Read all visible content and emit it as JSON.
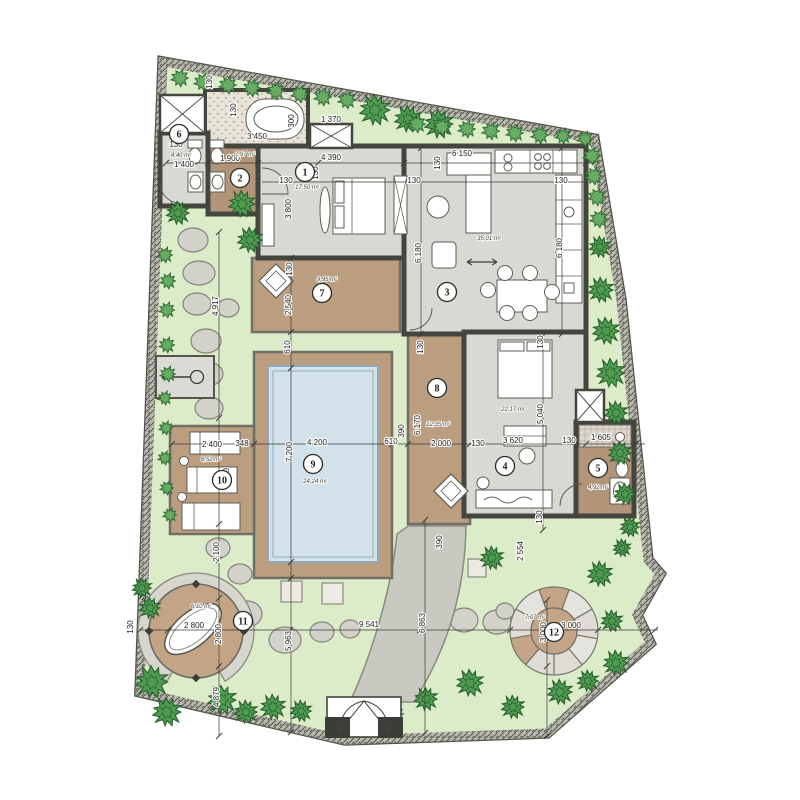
{
  "title": "villa-site-plan",
  "colors": {
    "paper": "#ffffff",
    "garden": "#dcebc8",
    "boundary_band": "#b9b9b0",
    "boundary_line": "#54544c",
    "wall": "#45453f",
    "room_gray": "#d9d9d4",
    "bath_brown": "#b29478",
    "deck_brown": "#bb9d7f",
    "gravel": "#e8e3d9",
    "pool_water": "#d3e2ea",
    "pool_line": "#8fa9b8",
    "stone": "#d2d1ca",
    "stone_line": "#83837b",
    "path": "#c9c9c2",
    "tree_big": "#4f9b51",
    "tree_big_line": "#27602c",
    "bush": "#68ab62",
    "bush_line": "#2f6b35",
    "dim_line": "#3c3c38",
    "round_deck": "#c3a486",
    "ring_gray": "#d6d6cf"
  },
  "boundary": [
    [
      163,
      62
    ],
    [
      594,
      139
    ],
    [
      621,
      300
    ],
    [
      648,
      560
    ],
    [
      660,
      574
    ],
    [
      637,
      615
    ],
    [
      650,
      643
    ],
    [
      547,
      733
    ],
    [
      345,
      740
    ],
    [
      140,
      692
    ]
  ],
  "rooms": [
    {
      "num": "1",
      "cx": 305,
      "cy": 172,
      "area": "17,50 m²",
      "ax": 307,
      "ay": 189
    },
    {
      "num": "2",
      "cx": 240,
      "cy": 178,
      "area": "7,97 m²",
      "ax": 245,
      "ay": 156
    },
    {
      "num": "3",
      "cx": 447,
      "cy": 292,
      "area": "35,01 m²",
      "ax": 489,
      "ay": 240
    },
    {
      "num": "4",
      "cx": 505,
      "cy": 466,
      "area": "22,17 m²",
      "ax": 513,
      "ay": 411
    },
    {
      "num": "5",
      "cx": 598,
      "cy": 468,
      "area": "4,92 m²",
      "ax": 598,
      "ay": 489
    },
    {
      "num": "6",
      "cx": 179,
      "cy": 134,
      "area": "4,40 m²",
      "ax": 181,
      "ay": 157
    },
    {
      "num": "7",
      "cx": 322,
      "cy": 293,
      "area": "9,95 m²",
      "ax": 327,
      "ay": 281
    },
    {
      "num": "8",
      "cx": 437,
      "cy": 388,
      "area": "12,35 m²",
      "ax": 438,
      "ay": 426
    },
    {
      "num": "9",
      "cx": 313,
      "cy": 464,
      "area": "24,24 m²",
      "ax": 315,
      "ay": 483
    },
    {
      "num": "10",
      "cx": 222,
      "cy": 480,
      "area": "8,52 m²",
      "ax": 211,
      "ay": 461
    },
    {
      "num": "11",
      "cx": 243,
      "cy": 621,
      "area": "6,10 m²",
      "ax": 201,
      "ay": 608
    },
    {
      "num": "12",
      "cx": 554,
      "cy": 632,
      "area": "7,07 m²",
      "ax": 535,
      "ay": 619
    }
  ],
  "dims": [
    {
      "t": "130",
      "x": 176,
      "y": 147,
      "r": 0
    },
    {
      "t": "1 400",
      "x": 184,
      "y": 167,
      "r": 0
    },
    {
      "t": "1 900",
      "x": 230,
      "y": 161,
      "r": 0
    },
    {
      "t": "130",
      "x": 212,
      "y": 82,
      "r": 90
    },
    {
      "t": "130",
      "x": 236,
      "y": 110,
      "r": 90
    },
    {
      "t": "3 450",
      "x": 257,
      "y": 139,
      "r": 0
    },
    {
      "t": "300",
      "x": 294,
      "y": 121,
      "r": 90
    },
    {
      "t": "1 370",
      "x": 331,
      "y": 122,
      "r": 0
    },
    {
      "t": "4 390",
      "x": 331,
      "y": 160,
      "r": 0
    },
    {
      "t": "130",
      "x": 318,
      "y": 173,
      "r": 90
    },
    {
      "t": "130",
      "x": 286,
      "y": 183,
      "r": 0
    },
    {
      "t": "3 800",
      "x": 291,
      "y": 209,
      "r": 90
    },
    {
      "t": "6 150",
      "x": 462,
      "y": 156,
      "r": 0
    },
    {
      "t": "130",
      "x": 414,
      "y": 183,
      "r": 0
    },
    {
      "t": "130",
      "x": 561,
      "y": 183,
      "r": 0
    },
    {
      "t": "130",
      "x": 440,
      "y": 163,
      "r": 90
    },
    {
      "t": "6 180",
      "x": 421,
      "y": 253,
      "r": 90
    },
    {
      "t": "6 180",
      "x": 562,
      "y": 248,
      "r": 90
    },
    {
      "t": "130",
      "x": 292,
      "y": 269,
      "r": 90
    },
    {
      "t": "2 540",
      "x": 291,
      "y": 305,
      "r": 90
    },
    {
      "t": "610",
      "x": 290,
      "y": 347,
      "r": 90
    },
    {
      "t": "130",
      "x": 423,
      "y": 347,
      "r": 90
    },
    {
      "t": "130",
      "x": 543,
      "y": 342,
      "r": 90
    },
    {
      "t": "5 040",
      "x": 543,
      "y": 414,
      "r": 90
    },
    {
      "t": "6 170",
      "x": 420,
      "y": 425,
      "r": 90
    },
    {
      "t": "390",
      "x": 404,
      "y": 431,
      "r": 90
    },
    {
      "t": "2 400",
      "x": 212,
      "y": 447,
      "r": 0
    },
    {
      "t": "348",
      "x": 242,
      "y": 446,
      "r": 0
    },
    {
      "t": "4 200",
      "x": 317,
      "y": 445,
      "r": 0
    },
    {
      "t": "610",
      "x": 391,
      "y": 444,
      "r": 0
    },
    {
      "t": "2 000",
      "x": 441,
      "y": 446,
      "r": 0
    },
    {
      "t": "130",
      "x": 478,
      "y": 446,
      "r": 0
    },
    {
      "t": "3 620",
      "x": 513,
      "y": 443,
      "r": 0
    },
    {
      "t": "130",
      "x": 569,
      "y": 443,
      "r": 0
    },
    {
      "t": "1 605",
      "x": 601,
      "y": 440,
      "r": 0
    },
    {
      "t": "7 200",
      "x": 292,
      "y": 452,
      "r": 90
    },
    {
      "t": "3 550",
      "x": 229,
      "y": 478,
      "r": 90
    },
    {
      "t": "2 100",
      "x": 219,
      "y": 552,
      "r": 90
    },
    {
      "t": "4 917",
      "x": 218,
      "y": 306,
      "r": 90
    },
    {
      "t": "130",
      "x": 542,
      "y": 517,
      "r": 90
    },
    {
      "t": "2 554",
      "x": 523,
      "y": 551,
      "r": 90
    },
    {
      "t": "390",
      "x": 442,
      "y": 542,
      "r": 90
    },
    {
      "t": "2 800",
      "x": 194,
      "y": 628,
      "r": 0
    },
    {
      "t": "2 800",
      "x": 221,
      "y": 634,
      "r": 90
    },
    {
      "t": "4 879",
      "x": 219,
      "y": 697,
      "r": 90
    },
    {
      "t": "5 963",
      "x": 291,
      "y": 641,
      "r": 90
    },
    {
      "t": "9 541",
      "x": 369,
      "y": 627,
      "r": 0
    },
    {
      "t": "6 863",
      "x": 425,
      "y": 623,
      "r": 90
    },
    {
      "t": "3 000",
      "x": 571,
      "y": 628,
      "r": 0
    },
    {
      "t": "3 000",
      "x": 546,
      "y": 632,
      "r": 90
    },
    {
      "t": "130",
      "x": 133,
      "y": 627,
      "r": 90
    }
  ],
  "dim_lines": [
    [
      166,
      163,
      596,
      163
    ],
    [
      262,
      182,
      586,
      182
    ],
    [
      172,
      444,
      645,
      444
    ],
    [
      140,
      630,
      658,
      630
    ],
    [
      219,
      232,
      219,
      736
    ],
    [
      291,
      258,
      291,
      732
    ],
    [
      425,
      520,
      425,
      733
    ],
    [
      547,
      600,
      547,
      736
    ],
    [
      543,
      336,
      543,
      530
    ],
    [
      421,
      148,
      421,
      334
    ],
    [
      562,
      148,
      562,
      334
    ]
  ],
  "trees_big": [
    [
      375,
      110,
      16
    ],
    [
      408,
      119,
      14
    ],
    [
      439,
      124,
      15
    ],
    [
      178,
      213,
      12
    ],
    [
      242,
      204,
      14
    ],
    [
      250,
      240,
      13
    ],
    [
      600,
      247,
      11
    ],
    [
      601,
      290,
      13
    ],
    [
      606,
      331,
      14
    ],
    [
      611,
      373,
      15
    ],
    [
      616,
      413,
      12
    ],
    [
      620,
      453,
      12
    ],
    [
      625,
      494,
      11
    ],
    [
      630,
      527,
      10
    ],
    [
      622,
      548,
      9
    ],
    [
      600,
      574,
      13
    ],
    [
      492,
      558,
      12
    ],
    [
      152,
      682,
      17
    ],
    [
      167,
      712,
      15
    ],
    [
      222,
      700,
      15
    ],
    [
      246,
      712,
      12
    ],
    [
      273,
      707,
      13
    ],
    [
      301,
      711,
      11
    ],
    [
      426,
      699,
      12
    ],
    [
      470,
      683,
      14
    ],
    [
      513,
      707,
      12
    ],
    [
      560,
      692,
      13
    ],
    [
      588,
      681,
      11
    ],
    [
      616,
      663,
      13
    ],
    [
      612,
      621,
      11
    ],
    [
      142,
      588,
      10
    ],
    [
      150,
      608,
      11
    ]
  ],
  "bushes": [
    [
      180,
      78,
      9
    ],
    [
      203,
      82,
      9
    ],
    [
      228,
      85,
      9
    ],
    [
      252,
      88,
      9
    ],
    [
      276,
      91,
      9
    ],
    [
      300,
      94,
      9
    ],
    [
      323,
      97,
      9
    ],
    [
      347,
      100,
      9
    ],
    [
      417,
      124,
      9
    ],
    [
      442,
      127,
      9
    ],
    [
      467,
      129,
      9
    ],
    [
      491,
      131,
      9
    ],
    [
      515,
      133,
      9
    ],
    [
      540,
      135,
      9
    ],
    [
      563,
      136,
      8
    ],
    [
      585,
      139,
      8
    ],
    [
      592,
      156,
      9
    ],
    [
      594,
      176,
      9
    ],
    [
      597,
      197,
      9
    ],
    [
      599,
      219,
      9
    ],
    [
      165,
      255,
      8
    ],
    [
      168,
      281,
      8
    ],
    [
      167,
      310,
      8
    ],
    [
      167,
      345,
      8
    ],
    [
      168,
      374,
      8
    ],
    [
      165,
      398,
      7
    ],
    [
      166,
      428,
      7
    ],
    [
      165,
      458,
      7
    ],
    [
      167,
      488,
      7
    ],
    [
      170,
      515,
      7
    ],
    [
      345,
      706,
      9
    ],
    [
      371,
      711,
      8
    ],
    [
      396,
      714,
      8
    ]
  ],
  "stones": [
    [
      193,
      240,
      15,
      12
    ],
    [
      199,
      273,
      16,
      12
    ],
    [
      197,
      304,
      14,
      11
    ],
    [
      228,
      308,
      11,
      9
    ],
    [
      206,
      341,
      15,
      12
    ],
    [
      207,
      374,
      16,
      12
    ],
    [
      209,
      408,
      14,
      11
    ],
    [
      218,
      548,
      12,
      10
    ],
    [
      240,
      574,
      12,
      10
    ],
    [
      247,
      614,
      15,
      13
    ],
    [
      285,
      640,
      16,
      13
    ],
    [
      322,
      632,
      12,
      10
    ],
    [
      350,
      629,
      10,
      9
    ],
    [
      430,
      627,
      13,
      11
    ],
    [
      464,
      620,
      14,
      12
    ],
    [
      497,
      622,
      14,
      12
    ],
    [
      523,
      618,
      10,
      9
    ],
    [
      505,
      611,
      9,
      8
    ]
  ],
  "pavers": [
    [
      281,
      581,
      21,
      21
    ],
    [
      322,
      583,
      21,
      21
    ],
    [
      432,
      557,
      18,
      18
    ],
    [
      468,
      559,
      18,
      18
    ]
  ]
}
